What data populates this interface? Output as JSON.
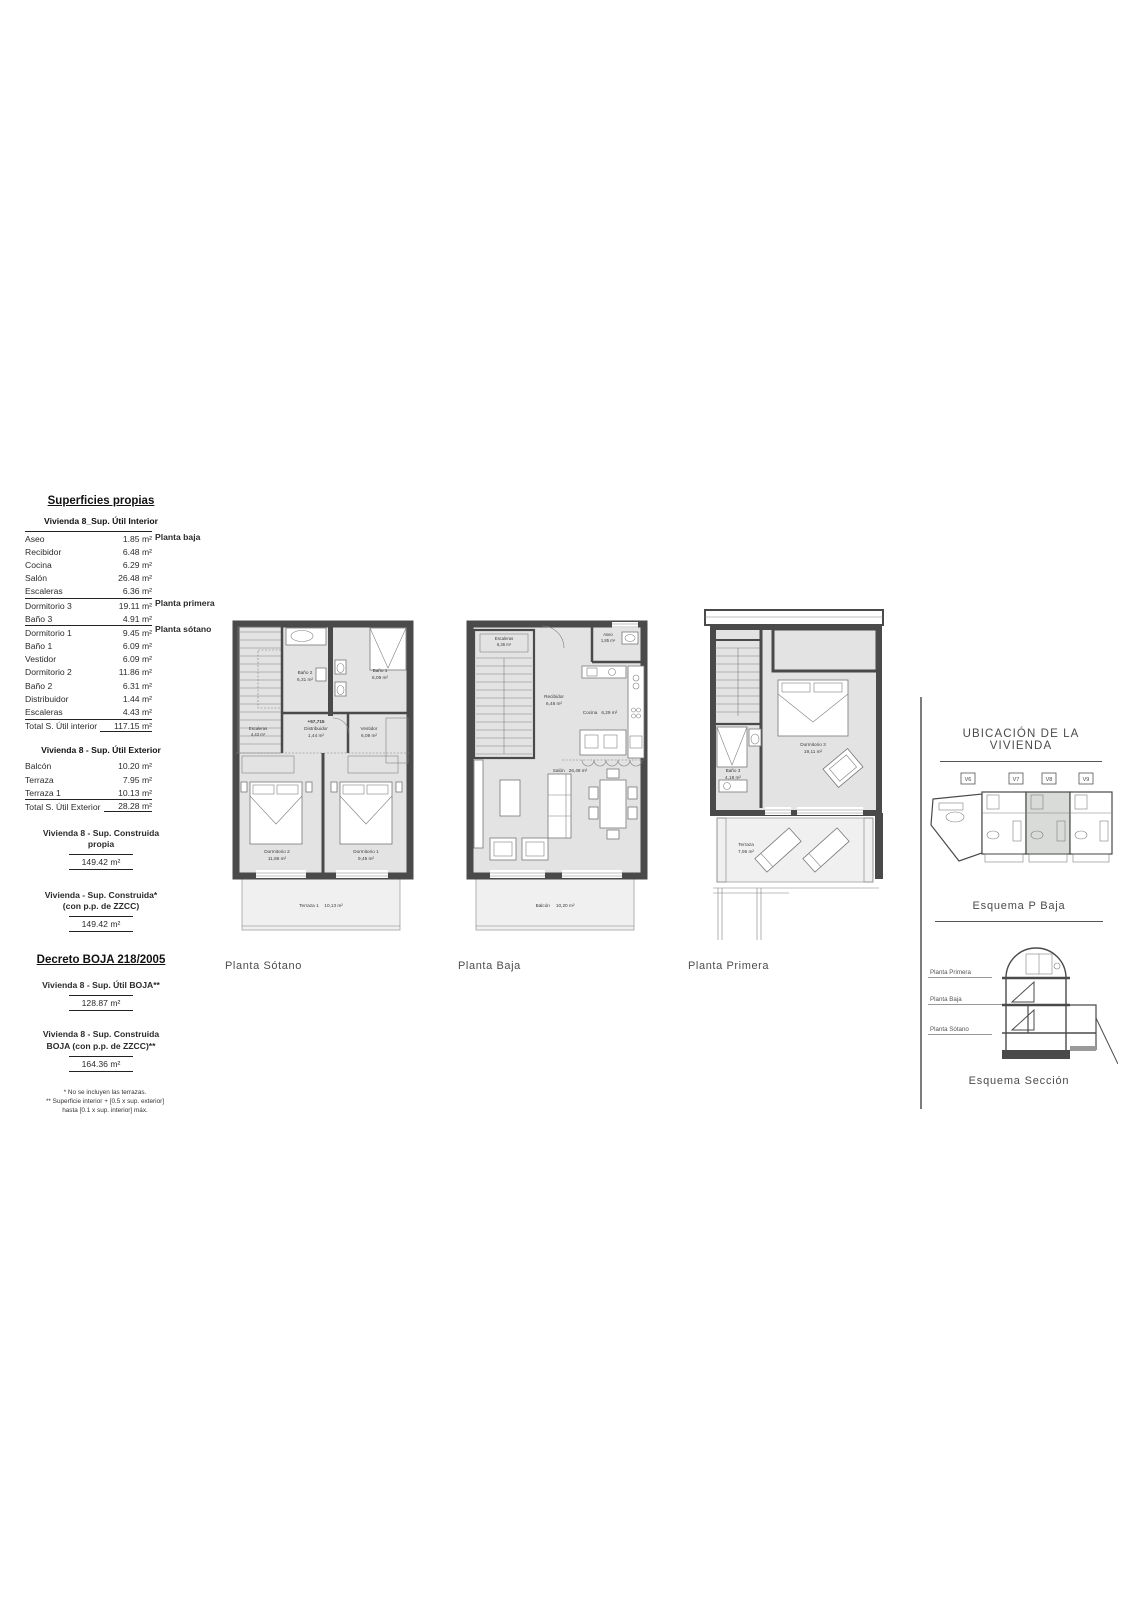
{
  "superficies": {
    "title": "Superficies propias",
    "interior_subtitle": "Vivienda 8_Sup. Útil Interior",
    "interior_rows": [
      {
        "label": "Aseo",
        "value": "1.85 m²"
      },
      {
        "label": "Recibidor",
        "value": "6.48 m²"
      },
      {
        "label": "Cocina",
        "value": "6.29 m²"
      },
      {
        "label": "Salón",
        "value": "26.48 m²"
      },
      {
        "label": "Escaleras",
        "value": "6.36 m²"
      },
      {
        "label": "Dormitorio 3",
        "value": "19.11 m²"
      },
      {
        "label": "Baño 3",
        "value": "4.91 m²"
      },
      {
        "label": "Dormitorio 1",
        "value": "9.45 m²"
      },
      {
        "label": "Baño 1",
        "value": "6.09 m²"
      },
      {
        "label": "Vestidor",
        "value": "6.09 m²"
      },
      {
        "label": "Dormitorio 2",
        "value": "11.86 m²"
      },
      {
        "label": "Baño 2",
        "value": "6.31 m²"
      },
      {
        "label": "Distribuidor",
        "value": "1.44 m²"
      },
      {
        "label": "Escaleras",
        "value": "4.43 m²"
      }
    ],
    "group_labels": {
      "baja": "Planta baja",
      "primera": "Planta primera",
      "sotano": "Planta sótano"
    },
    "total_interior": {
      "label": "Total S. Útil interior",
      "value": "117.15 m²"
    },
    "exterior_subtitle": "Vivienda 8 - Sup. Útil Exterior",
    "exterior_rows": [
      {
        "label": "Balcón",
        "value": "10.20 m²"
      },
      {
        "label": "Terraza",
        "value": "7.95 m²"
      },
      {
        "label": "Terraza 1",
        "value": "10.13 m²"
      }
    ],
    "total_exterior": {
      "label": "Total S. Útil Exterior",
      "value": "28.28 m²"
    },
    "construida_propia": {
      "title_line1": "Vivienda 8 - Sup. Construida",
      "title_line2": "propia",
      "value": "149.42 m²"
    },
    "construida_zzcc": {
      "title_line1": "Vivienda - Sup. Construida*",
      "title_line2": "(con p.p. de ZZCC)",
      "value": "149.42 m²"
    },
    "decreto_title": "Decreto BOJA 218/2005",
    "util_boja": {
      "title": "Vivienda 8 - Sup. Útil BOJA**",
      "value": "128.87 m²"
    },
    "construida_boja": {
      "title_line1": "Vivienda 8  - Sup. Construida",
      "title_line2": "BOJA (con p.p. de ZZCC)**",
      "value": "164.36 m²"
    },
    "footnote1": "* No se incluyen las terrazas.",
    "footnote2": "** Superficie interior + [0.5 x sup. exterior]",
    "footnote3": "hasta  [0.1 x sup. interior] máx."
  },
  "plans": {
    "sotano": {
      "caption": "Planta Sótano",
      "elevation": "+57,715",
      "rooms": {
        "escaleras": {
          "name": "Escaleras",
          "area": "4,43 m²"
        },
        "bano2": {
          "name": "Baño 2",
          "area": "6,31 m²"
        },
        "bano1": {
          "name": "Baño 1",
          "area": "6,09 m²"
        },
        "distribuidor": {
          "name": "Distribuidor",
          "area": "1,44 m²"
        },
        "vestidor": {
          "name": "Vestidor",
          "area": "6,09 m²"
        },
        "dormitorio2": {
          "name": "Dormitorio 2",
          "area": "11,86 m²"
        },
        "dormitorio1": {
          "name": "Dormitorio 1",
          "area": "9,45 m²"
        },
        "terraza1": {
          "name": "Terraza 1",
          "area": "10,13 m²"
        }
      }
    },
    "baja": {
      "caption": "Planta Baja",
      "rooms": {
        "escaleras": {
          "name": "Escaleras",
          "area": "6,36 m²"
        },
        "aseo": {
          "name": "Aseo",
          "area": "1,85 m²"
        },
        "recibidor": {
          "name": "Recibidor",
          "area": "6,48 m²"
        },
        "cocina": {
          "name": "Cocina",
          "area": "6,29 m²"
        },
        "salon": {
          "name": "Salón",
          "area": "26,48 m²"
        },
        "balcon": {
          "name": "Balcón",
          "area": "10,20 m²"
        }
      }
    },
    "primera": {
      "caption": "Planta Primera",
      "rooms": {
        "dormitorio3": {
          "name": "Dormitorio 3",
          "area": "19,11 m²"
        },
        "bano3": {
          "name": "Baño 3",
          "area": "4,18 m²"
        },
        "terraza": {
          "name": "Terraza",
          "area": "7,95 m²"
        }
      }
    }
  },
  "right_panel": {
    "location_title": "UBICACIÓN DE LA VIVIENDA",
    "units": [
      "V6",
      "V7",
      "V8",
      "V9"
    ],
    "esquema_baja_title": "Esquema P Baja",
    "section_labels": {
      "primera": "Planta Primera",
      "baja": "Planta Baja",
      "sotano": "Planta Sótano"
    },
    "esquema_seccion_title": "Esquema Sección"
  },
  "colors": {
    "wall": "#4a4a4a",
    "floor": "#e3e3e3",
    "highlight_unit": "#d8dbd8"
  }
}
